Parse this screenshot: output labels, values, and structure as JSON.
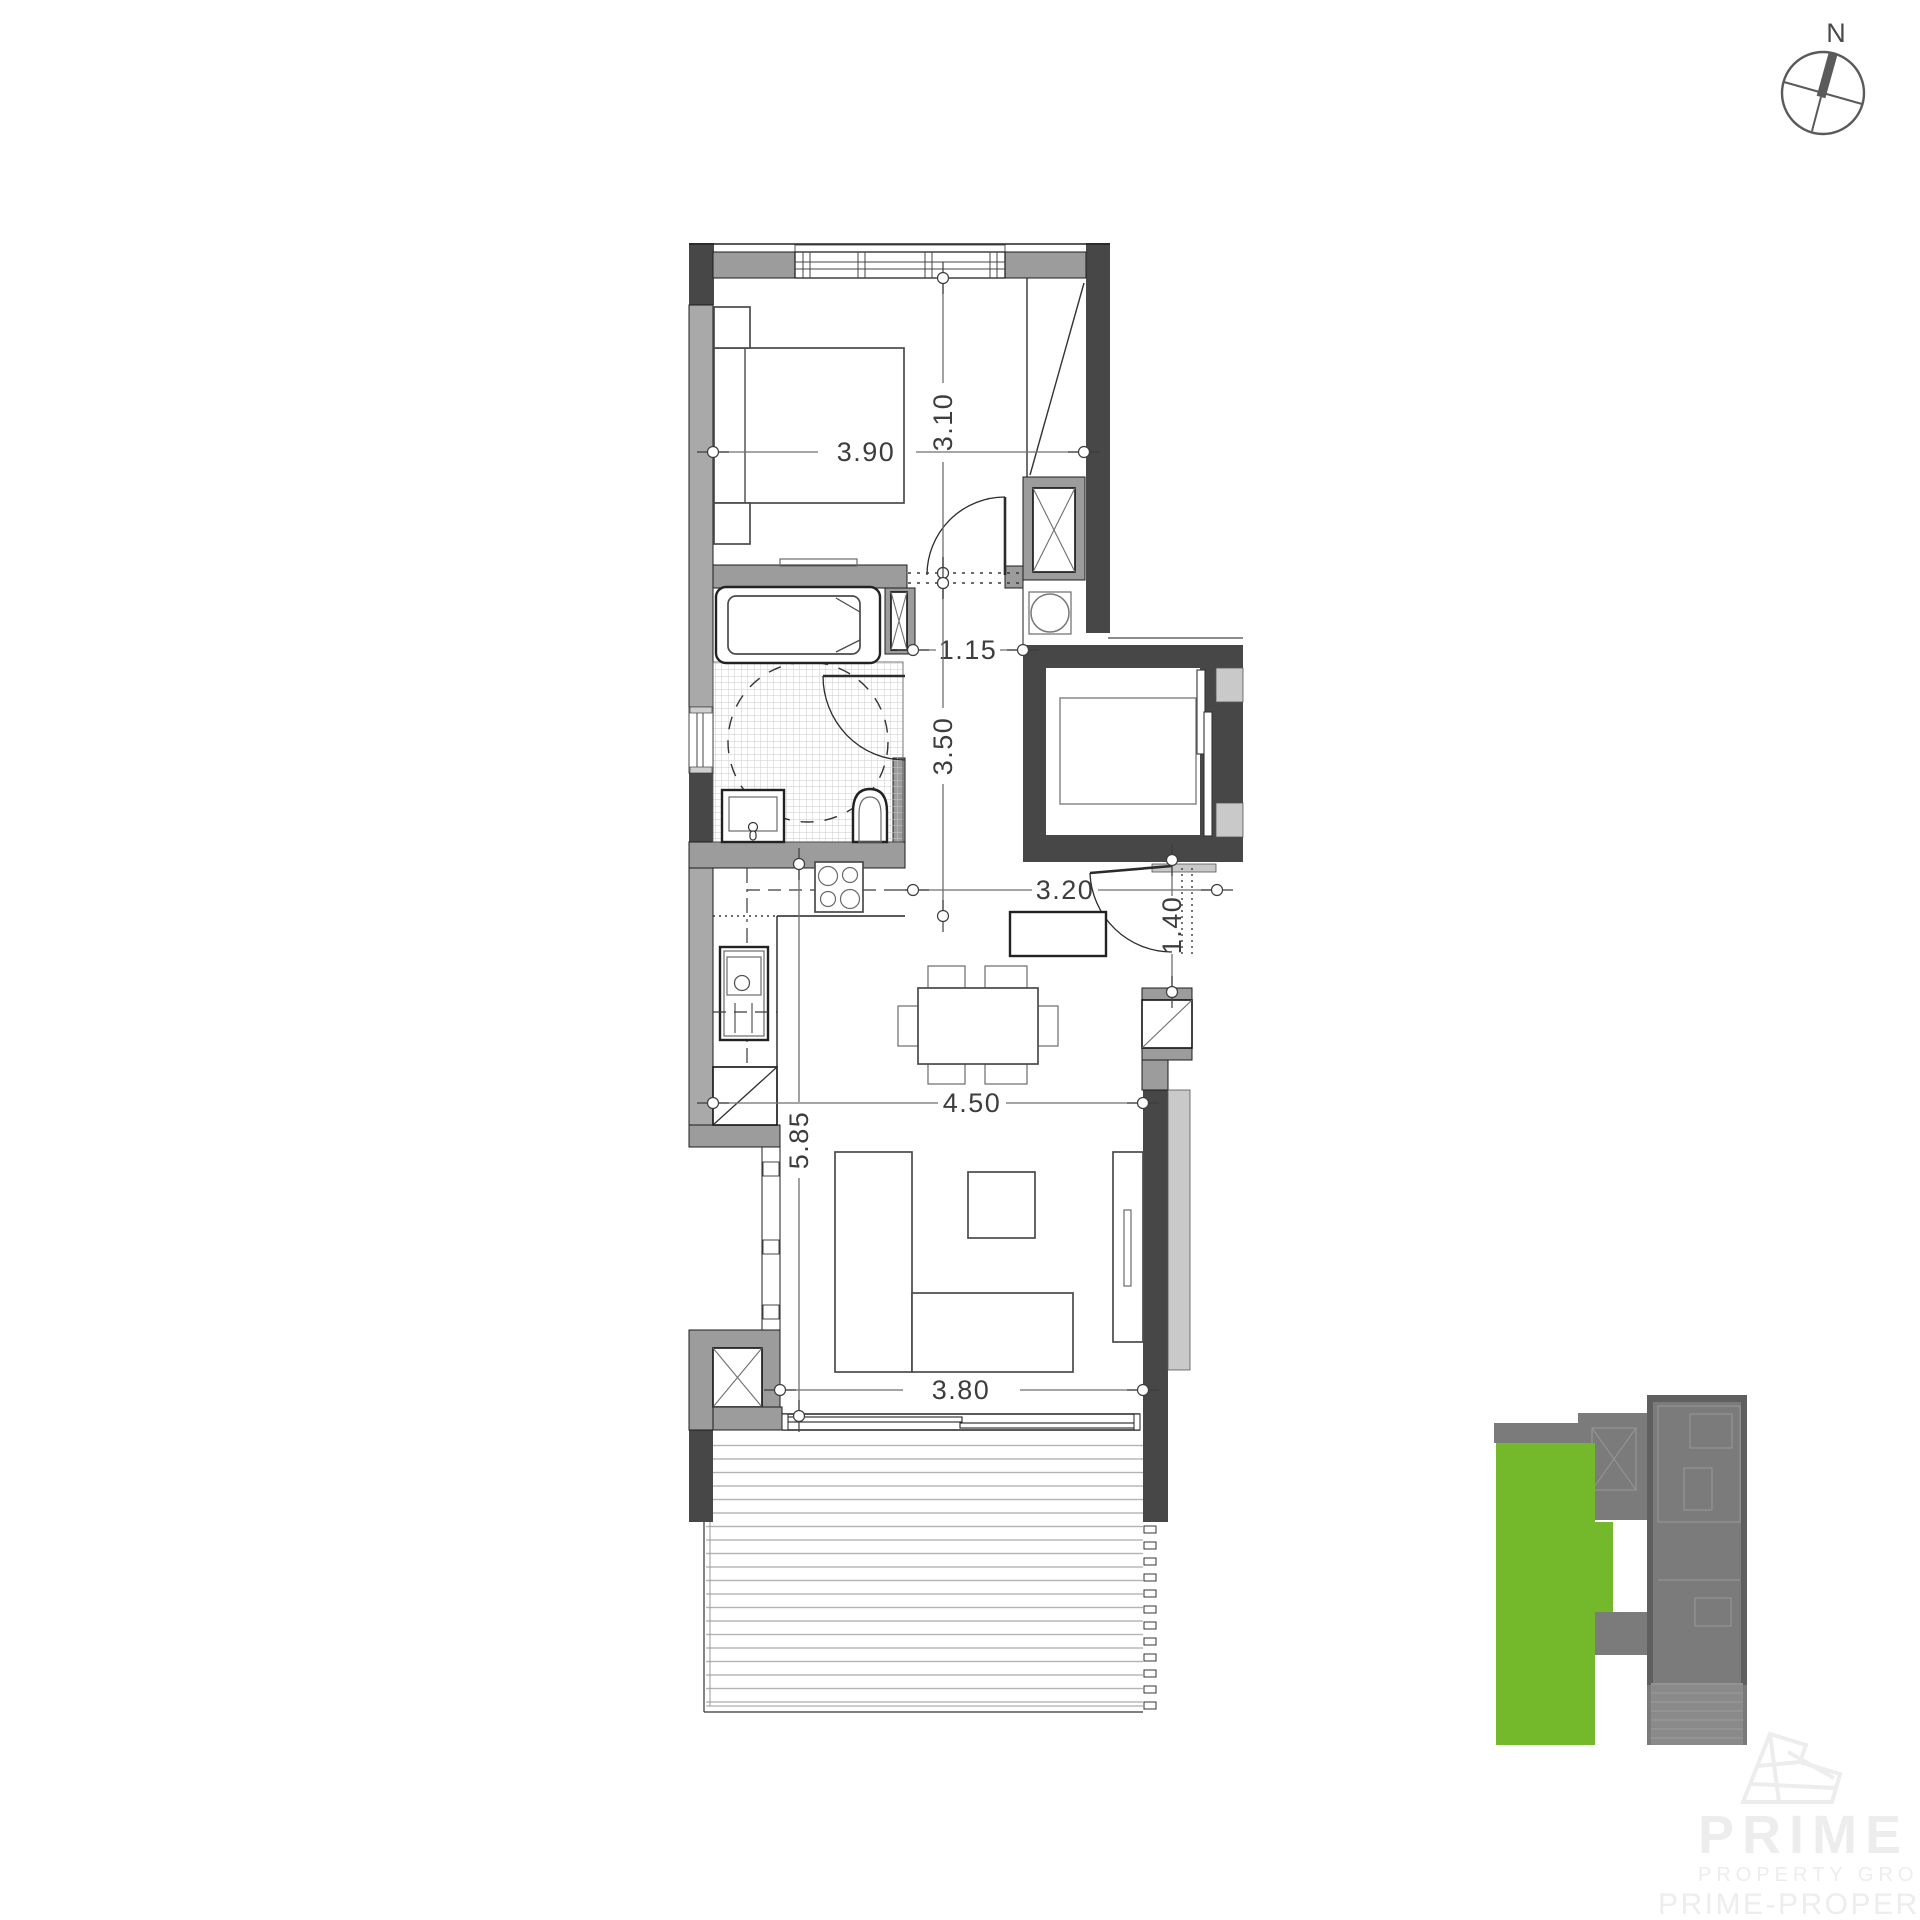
{
  "compass": {
    "label": "N"
  },
  "dimensions": {
    "bedroom_width": "3.90",
    "bedroom_depth": "3.10",
    "hall_width": "1.15",
    "hall_depth": "3.50",
    "living_upper_width": "3.20",
    "entry_opening": "1.40",
    "living_width": "4.50",
    "living_depth": "5.85",
    "balcony_opening": "3.80"
  },
  "watermark": {
    "brand": "PRIME",
    "tagline": "PROPERTY GROUP",
    "website": "PRIME-PROPERTY.COM"
  },
  "colors": {
    "unit_green": "#74b82c",
    "wall_dark": "#474747",
    "wall_medium": "#9c9c9c",
    "wall_light": "#a9a9a9",
    "dim_gray": "#3d3d3d",
    "minimap_gray": "#7b7b7b",
    "watermark_gray": "#ededed"
  }
}
